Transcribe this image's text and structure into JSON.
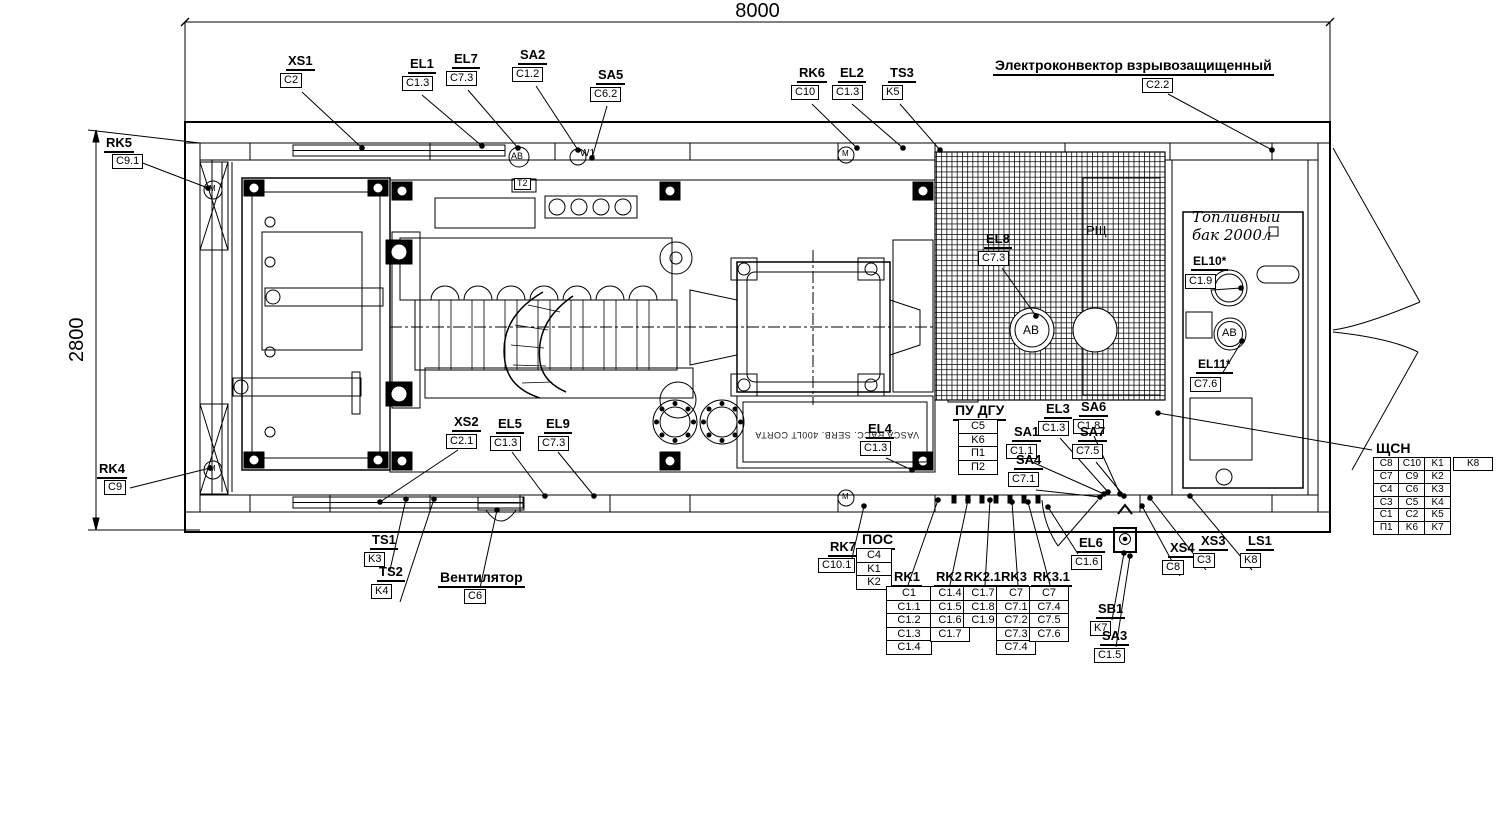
{
  "dimensions": {
    "width_mm": "8000",
    "height_mm": "2800"
  },
  "callouts": [
    {
      "id": "XS1",
      "value": "C2",
      "x": 286,
      "y": 54,
      "leader": [
        302,
        92,
        362,
        148
      ]
    },
    {
      "id": "EL1",
      "value": "C1.3",
      "x": 408,
      "y": 57,
      "leader": [
        422,
        95,
        482,
        146
      ]
    },
    {
      "id": "EL7",
      "value": "C7.3",
      "x": 452,
      "y": 52,
      "leader": [
        468,
        90,
        518,
        148
      ]
    },
    {
      "id": "SA2",
      "value": "C1.2",
      "x": 518,
      "y": 48,
      "leader": [
        536,
        86,
        578,
        150
      ]
    },
    {
      "id": "SA5",
      "value": "C6.2",
      "x": 596,
      "y": 68,
      "leader": [
        607,
        106,
        592,
        158
      ]
    },
    {
      "id": "RK6",
      "value": "C10",
      "x": 797,
      "y": 66,
      "leader": [
        812,
        104,
        857,
        148
      ]
    },
    {
      "id": "EL2",
      "value": "C1.3",
      "x": 838,
      "y": 66,
      "leader": [
        852,
        104,
        903,
        148
      ]
    },
    {
      "id": "TS3",
      "value": "K5",
      "x": 888,
      "y": 66,
      "leader": [
        900,
        104,
        940,
        150
      ]
    },
    {
      "id": "Электроконвектор взрывозащищенный",
      "value": "C2.2",
      "x": 993,
      "y": 58,
      "bx": 1142,
      "by": 78,
      "fs": 14,
      "leader": [
        1168,
        94,
        1272,
        150
      ]
    },
    {
      "id": "RK5",
      "value": "C9.1",
      "x": 104,
      "y": 136,
      "bx": 112,
      "by": 154,
      "leader": [
        140,
        162,
        208,
        188
      ]
    },
    {
      "id": "RK4",
      "value": "C9",
      "x": 97,
      "y": 462,
      "bx": 104,
      "by": 480,
      "leader": [
        130,
        488,
        210,
        468
      ]
    },
    {
      "id": "XS2",
      "value": "C2.1",
      "x": 452,
      "y": 415,
      "leader": [
        458,
        450,
        380,
        502
      ]
    },
    {
      "id": "EL5",
      "value": "C1.3",
      "x": 496,
      "y": 417,
      "leader": [
        512,
        452,
        545,
        496
      ]
    },
    {
      "id": "EL9",
      "value": "C7.3",
      "x": 544,
      "y": 417,
      "leader": [
        558,
        452,
        594,
        496
      ]
    },
    {
      "id": "EL4",
      "value": "C1.3",
      "x": 866,
      "y": 422,
      "leader": [
        886,
        458,
        912,
        470
      ]
    },
    {
      "id": "EL8",
      "value": "C7.3",
      "x": 984,
      "y": 232,
      "leader": [
        1002,
        268,
        1036,
        316
      ]
    },
    {
      "id": "EL3",
      "value": "C1.3",
      "x": 1044,
      "y": 402,
      "leader": [
        1060,
        438,
        1108,
        492
      ]
    },
    {
      "id": "SA6",
      "value": "C1.8",
      "x": 1079,
      "y": 400,
      "leader": [
        1094,
        436,
        1120,
        494
      ]
    },
    {
      "id": "SA1",
      "value": "C1.1",
      "x": 1012,
      "y": 425,
      "leader": [
        1032,
        462,
        1104,
        494
      ]
    },
    {
      "id": "SA7",
      "value": "C7.5",
      "x": 1078,
      "y": 425,
      "leader": [
        1096,
        462,
        1124,
        496
      ]
    },
    {
      "id": "SA4",
      "value": "C7.1",
      "x": 1014,
      "y": 453,
      "leader": [
        1036,
        490,
        1100,
        497
      ]
    },
    {
      "id": "EL10*",
      "value": "C1.9",
      "x": 1191,
      "y": 255,
      "fs": 12,
      "leader": [
        1212,
        290,
        1241,
        288
      ]
    },
    {
      "id": "EL11*",
      "value": "C7.6",
      "x": 1196,
      "y": 358,
      "fs": 12,
      "leader": [
        1222,
        374,
        1242,
        341
      ]
    },
    {
      "id": "TS1",
      "value": "K3",
      "x": 370,
      "y": 533,
      "leader": [
        390,
        570,
        406,
        499
      ]
    },
    {
      "id": "TS2",
      "value": "K4",
      "x": 377,
      "y": 565,
      "leader": [
        400,
        602,
        434,
        499
      ]
    },
    {
      "id": "Вентилятор",
      "value": "C6",
      "x": 438,
      "y": 570,
      "bx": 464,
      "by": 589,
      "fs": 14,
      "leader": [
        480,
        588,
        497,
        510
      ]
    },
    {
      "id": "RK7",
      "value": "C10.1",
      "x": 828,
      "y": 540,
      "bx": 818,
      "by": 558,
      "leader": [
        852,
        558,
        864,
        506
      ]
    },
    {
      "id": "EL6",
      "value": "C1.6",
      "x": 1077,
      "y": 536,
      "leader": [
        1078,
        554,
        1048,
        507
      ]
    },
    {
      "id": "SB1",
      "value": "K7",
      "x": 1096,
      "y": 602,
      "leader": [
        1112,
        620,
        1124,
        553
      ]
    },
    {
      "id": "SA3",
      "value": "C1.5",
      "x": 1100,
      "y": 629,
      "leader": [
        1116,
        647,
        1130,
        556
      ]
    },
    {
      "id": "XS4",
      "value": "C8",
      "x": 1168,
      "y": 541,
      "leader": [
        1180,
        576,
        1142,
        506
      ]
    },
    {
      "id": "XS3",
      "value": "C3",
      "x": 1199,
      "y": 534,
      "leader": [
        1206,
        570,
        1150,
        498
      ]
    },
    {
      "id": "LS1",
      "value": "K8",
      "x": 1246,
      "y": 534,
      "leader": [
        1252,
        570,
        1190,
        496
      ]
    }
  ],
  "stacks": [
    {
      "id": "ПУ ДГУ",
      "values": [
        "C5",
        "K6",
        "П1",
        "П2"
      ],
      "x": 953,
      "y": 403,
      "sx": 958,
      "sy": 421,
      "w": 34,
      "fs": 14
    },
    {
      "id": "ПОС",
      "values": [
        "C4",
        "K1",
        "K2"
      ],
      "x": 860,
      "y": 532,
      "sx": 856,
      "sy": 550,
      "w": 30,
      "fs": 14
    },
    {
      "id": "RK1",
      "values": [
        "C1",
        "C1.1",
        "C1.2",
        "C1.3",
        "C1.4"
      ],
      "x": 892,
      "y": 570,
      "sx": 886,
      "sy": 588,
      "w": 40,
      "leader": [
        908,
        585,
        938,
        500
      ]
    },
    {
      "id": "RK2",
      "values": [
        "C1.4",
        "C1.5",
        "C1.6",
        "C1.7"
      ],
      "x": 934,
      "y": 570,
      "sx": 930,
      "sy": 588,
      "w": 34,
      "leader": [
        950,
        585,
        968,
        500
      ]
    },
    {
      "id": "RK2.1",
      "values": [
        "C1.7",
        "C1.8",
        "C1.9"
      ],
      "x": 962,
      "y": 570,
      "sx": 963,
      "sy": 588,
      "w": 34,
      "leader": [
        985,
        585,
        990,
        500
      ]
    },
    {
      "id": "RK3",
      "values": [
        "C7",
        "C7.1",
        "C7.2",
        "C7.3",
        "C7.4"
      ],
      "x": 999,
      "y": 570,
      "sx": 996,
      "sy": 588,
      "w": 34,
      "leader": [
        1018,
        585,
        1012,
        502
      ]
    },
    {
      "id": "RK3.1",
      "values": [
        "C7",
        "C7.4",
        "C7.5",
        "C7.6"
      ],
      "x": 1031,
      "y": 570,
      "sx": 1029,
      "sy": 588,
      "w": 34,
      "leader": [
        1050,
        585,
        1028,
        502
      ]
    }
  ],
  "panel_table": {
    "title": "ЩСН",
    "x": 1374,
    "y": 440,
    "leader": [
      1372,
      450,
      1158,
      413
    ],
    "rows": [
      [
        "C8",
        "C10",
        "K1",
        "K8"
      ],
      [
        "C7",
        "C9",
        "K2"
      ],
      [
        "C4",
        "C6",
        "K3"
      ],
      [
        "C3",
        "C5",
        "K4"
      ],
      [
        "C1",
        "C2",
        "K5"
      ],
      [
        "П1",
        "K6",
        "K7"
      ]
    ]
  },
  "labels": [
    {
      "id": "room-rsh",
      "text": "РЩ",
      "x": 1086,
      "y": 224,
      "fs": 13
    },
    {
      "id": "fuel-tank-line1",
      "text": "Топливный",
      "x": 1192,
      "y": 210,
      "cls": "it"
    },
    {
      "id": "fuel-tank-line2",
      "text": "бак 2000л",
      "x": 1192,
      "y": 228,
      "cls": "it"
    },
    {
      "id": "vasca-text",
      "text": "VASCA RACC. SERB. 400LT CORTA",
      "x": 742,
      "y": 430,
      "cls": "vasca"
    },
    {
      "id": "ab-breaker-mesh",
      "text": "АВ",
      "x": 1023,
      "y": 324,
      "fs": 12
    },
    {
      "id": "ab-breaker-tank",
      "text": "АВ",
      "x": 1222,
      "y": 328,
      "fs": 11
    },
    {
      "id": "ab-breaker-top",
      "text": "АВ",
      "x": 511,
      "y": 152,
      "fs": 9
    },
    {
      "id": "motor-top-left",
      "text": "М",
      "x": 209,
      "y": 185,
      "fs": 8
    },
    {
      "id": "motor-bottom-left",
      "text": "М",
      "x": 209,
      "y": 465,
      "fs": 8
    },
    {
      "id": "motor-top-mid",
      "text": "М",
      "x": 842,
      "y": 150,
      "fs": 8
    },
    {
      "id": "motor-bottom-mid",
      "text": "М",
      "x": 842,
      "y": 493,
      "fs": 8
    },
    {
      "id": "w1-label",
      "text": "W1",
      "x": 580,
      "y": 149,
      "fs": 10
    },
    {
      "id": "t2-label",
      "text": "Т2",
      "x": 514,
      "y": 178,
      "fs": 9,
      "cls": "boxed"
    }
  ]
}
